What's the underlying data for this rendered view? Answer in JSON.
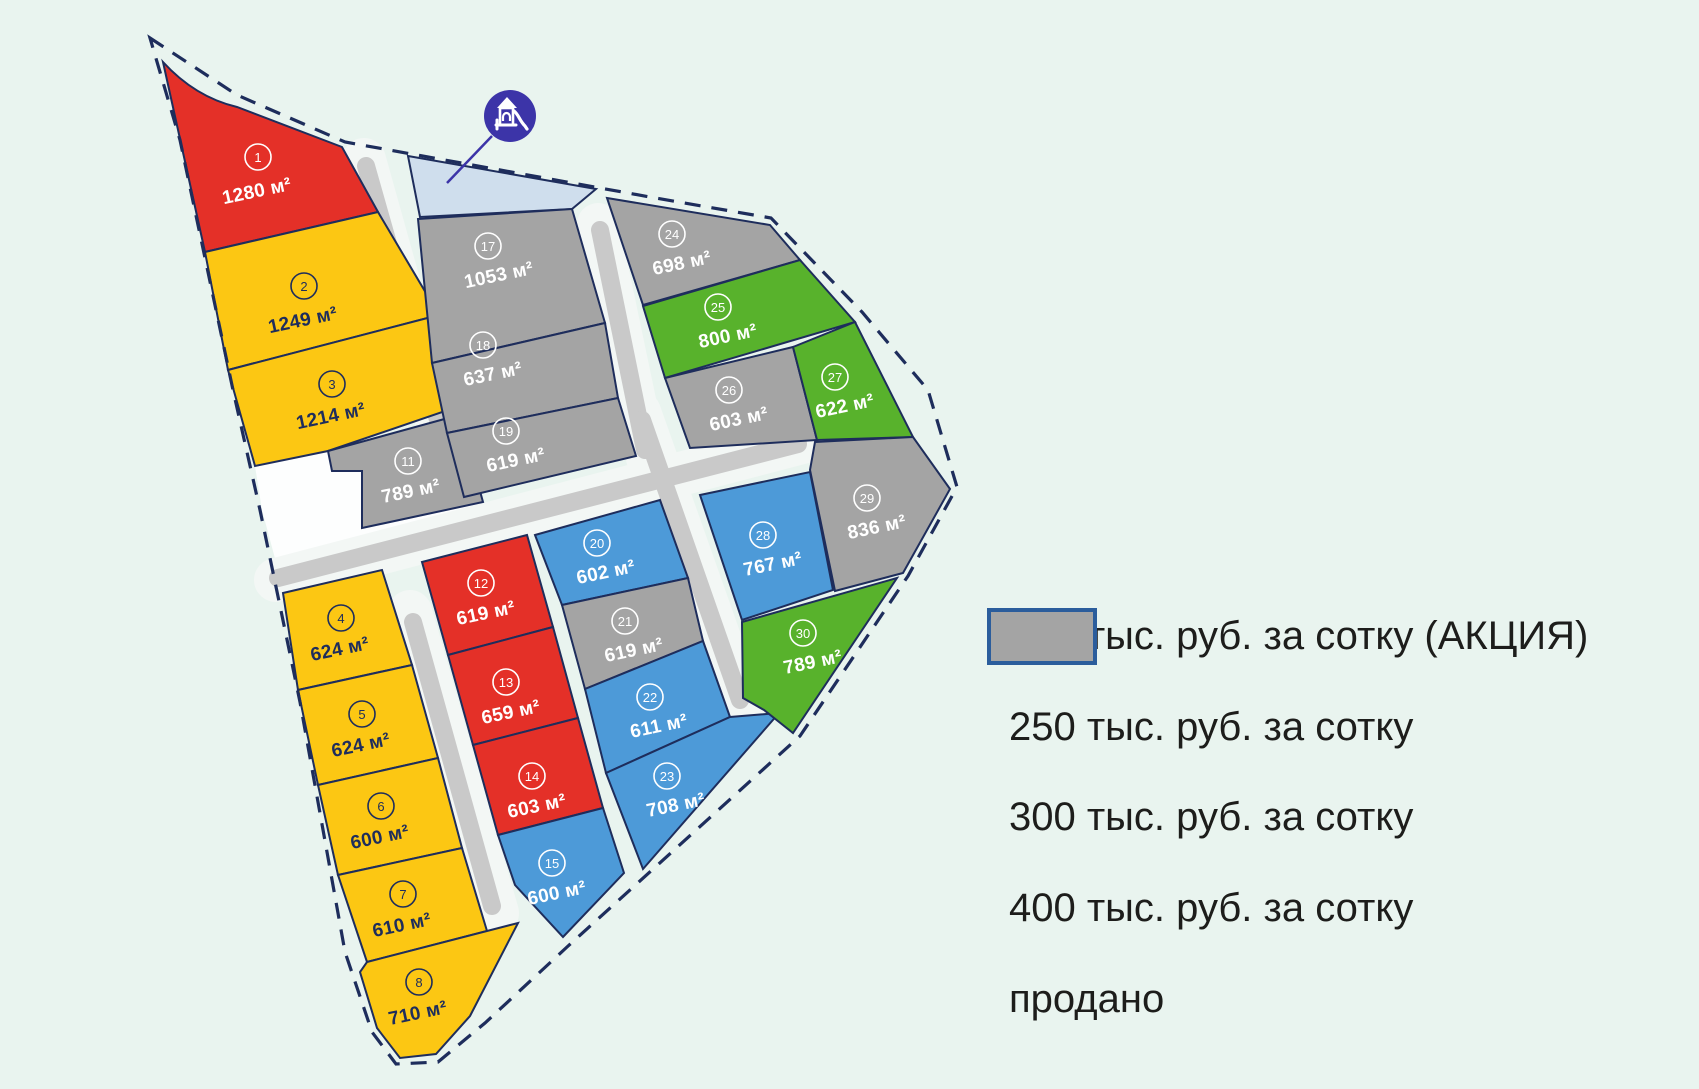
{
  "colors": {
    "yellow": "#FCC713",
    "red": "#E43028",
    "blue": "#4D9AD8",
    "green": "#58B22C",
    "gray": "#A4A4A4",
    "navy": "#1E2D5C",
    "white": "#FFFFFF",
    "road": "#C9C9C9",
    "corridor": "#F3F7F5",
    "white_area": "#FDFEFE",
    "playground_area": "#CFDEED",
    "icon_bg": "#3C34A8",
    "background": "#E9F4EF",
    "legend_swatch_border": "#2B5D9C",
    "legend_text": "#1D1D1B"
  },
  "legend": {
    "items": [
      {
        "tier": "yellow",
        "label": "200 тыс. руб. за сотку (АКЦИЯ)"
      },
      {
        "tier": "red",
        "label": "250 тыс. руб. за сотку"
      },
      {
        "tier": "blue",
        "label": "300 тыс. руб. за сотку"
      },
      {
        "tier": "green",
        "label": "400 тыс. руб. за сотку"
      },
      {
        "tier": "gray",
        "label": "продано"
      }
    ]
  },
  "plots": [
    {
      "number": "1",
      "area": "1280 м²",
      "tier": "red"
    },
    {
      "number": "2",
      "area": "1249 м²",
      "tier": "yellow"
    },
    {
      "number": "3",
      "area": "1214 м²",
      "tier": "yellow"
    },
    {
      "number": "4",
      "area": "624 м²",
      "tier": "yellow"
    },
    {
      "number": "5",
      "area": "624 м²",
      "tier": "yellow"
    },
    {
      "number": "6",
      "area": "600 м²",
      "tier": "yellow"
    },
    {
      "number": "7",
      "area": "610 м²",
      "tier": "yellow"
    },
    {
      "number": "8",
      "area": "710 м²",
      "tier": "yellow"
    },
    {
      "number": "11",
      "area": "789 м²",
      "tier": "gray"
    },
    {
      "number": "12",
      "area": "619 м²",
      "tier": "red"
    },
    {
      "number": "13",
      "area": "659 м²",
      "tier": "red"
    },
    {
      "number": "14",
      "area": "603 м²",
      "tier": "red"
    },
    {
      "number": "15",
      "area": "600 м²",
      "tier": "blue"
    },
    {
      "number": "17",
      "area": "1053 м²",
      "tier": "gray"
    },
    {
      "number": "18",
      "area": "637 м²",
      "tier": "gray"
    },
    {
      "number": "19",
      "area": "619 м²",
      "tier": "gray"
    },
    {
      "number": "20",
      "area": "602 м²",
      "tier": "blue"
    },
    {
      "number": "21",
      "area": "619 м²",
      "tier": "gray"
    },
    {
      "number": "22",
      "area": "611 м²",
      "tier": "blue"
    },
    {
      "number": "23",
      "area": "708 м²",
      "tier": "blue"
    },
    {
      "number": "24",
      "area": "698 м²",
      "tier": "gray"
    },
    {
      "number": "25",
      "area": "800 м²",
      "tier": "green"
    },
    {
      "number": "26",
      "area": "603 м²",
      "tier": "gray"
    },
    {
      "number": "27",
      "area": "622 м²",
      "tier": "green"
    },
    {
      "number": "28",
      "area": "767 м²",
      "tier": "blue"
    },
    {
      "number": "29",
      "area": "836 м²",
      "tier": "gray"
    },
    {
      "number": "30",
      "area": "789 м²",
      "tier": "green"
    }
  ]
}
